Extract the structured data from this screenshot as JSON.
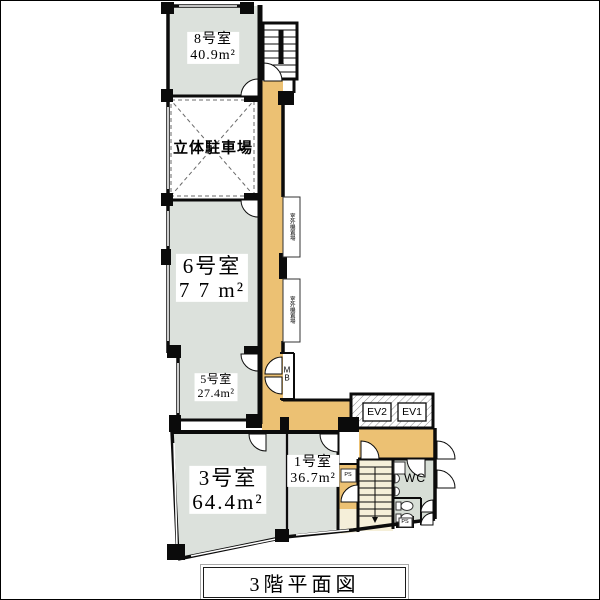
{
  "title": "3階平面図",
  "rooms": {
    "room8": {
      "name": "8号室",
      "area": "40.9m²"
    },
    "parking": {
      "name": "立体駐車場"
    },
    "room6": {
      "name": "6号室",
      "area": "7 7 m²"
    },
    "room5": {
      "name": "5号室",
      "area": "27.4m²"
    },
    "room3": {
      "name": "3号室",
      "area": "64.4m²"
    },
    "room1": {
      "name": "1号室",
      "area": "36.7m²"
    }
  },
  "facilities": {
    "ev1": "EV1",
    "ev2": "EV2",
    "wc": "WC",
    "mb": "MB",
    "ps_upper": "PS",
    "ps_lower": "PS",
    "outdoor_unit_upper": "室外機置場",
    "outdoor_unit_lower": "室外機置場"
  },
  "colors": {
    "room_fill": "#dce1dc",
    "corridor_fill": "#ecc173",
    "stair_fill": "#f5efd9",
    "wc_fill": "#d7ded6",
    "wall": "#0b0b0b"
  }
}
